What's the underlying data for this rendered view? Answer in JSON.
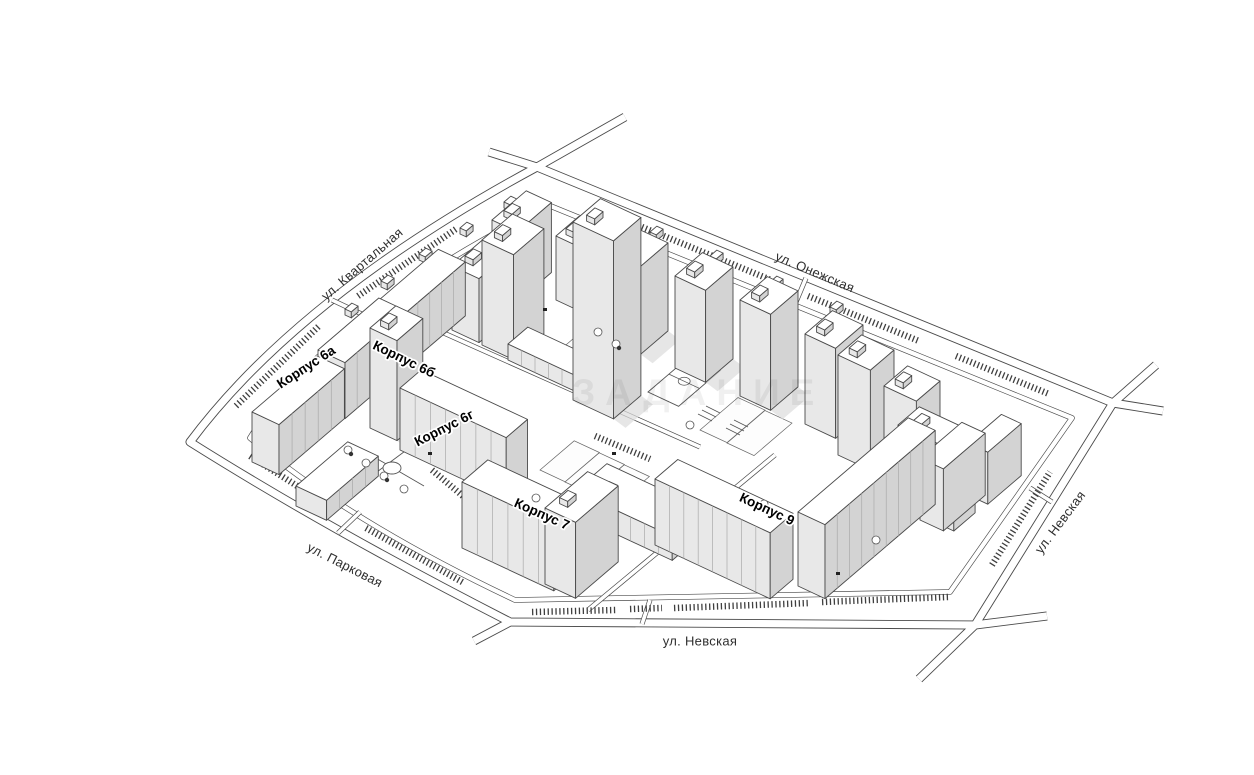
{
  "map": {
    "watermark": "ЗАДАНИЕ",
    "streets": {
      "kvartalnaya": "ул. Квартальная",
      "onezhskaya": "ул. Онежская",
      "nevskaya_right": "ул. Невская",
      "nevskaya_bottom": "ул. Невская",
      "parkovaya": "ул. Парковая"
    },
    "buildings": {
      "k6a": "Корпус 6а",
      "k6b": "Корпус 6б",
      "k6g": "Корпус 6г",
      "k7": "Корпус 7",
      "k9": "Корпус 9"
    },
    "colors": {
      "background": "#ffffff",
      "line": "#4a4a4a",
      "building_top": "#ffffff",
      "building_side_left": "#e8e8e8",
      "building_side_right": "#d3d3d3",
      "shadow": "#dcdcdc"
    }
  }
}
